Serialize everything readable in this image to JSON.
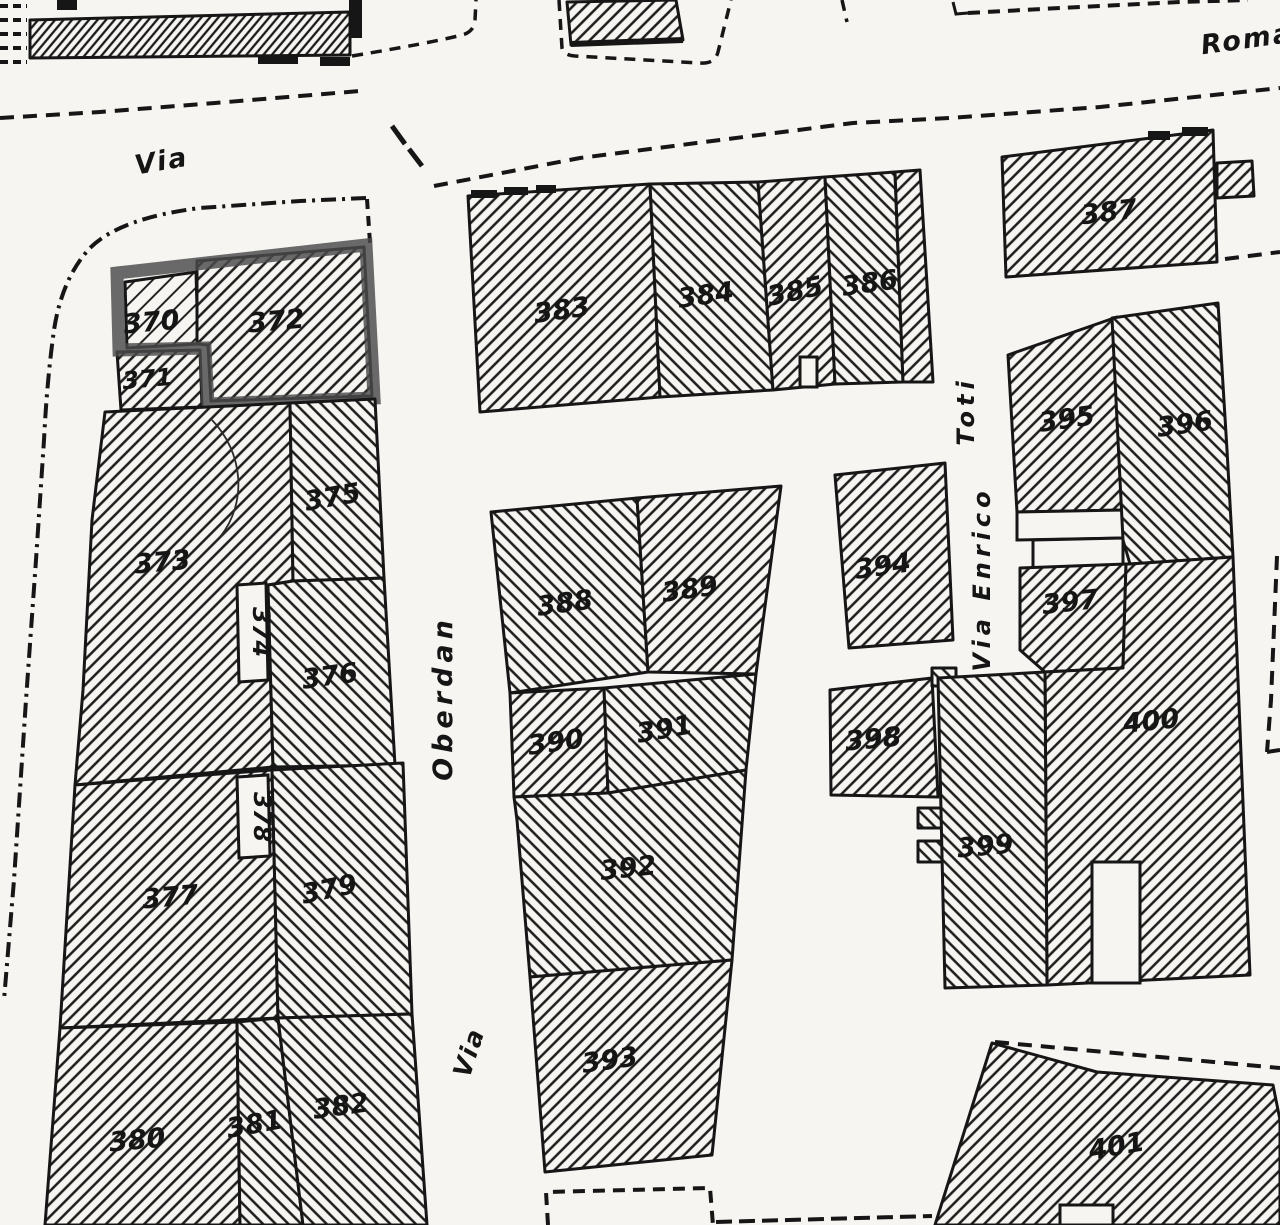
{
  "map_type": "cadastral-plan-scan",
  "colors": {
    "paper": "#f7f5f1",
    "ink": "#161616",
    "highlight_outline": "#4a4a4a"
  },
  "streets": {
    "via_top": "Via",
    "roma": "Roma",
    "oberdan": "Oberdan",
    "via_lower": "Via",
    "via_enrico": "Via Enrico",
    "toti": "Toti"
  },
  "parcels": [
    {
      "label": "370"
    },
    {
      "label": "371"
    },
    {
      "label": "372"
    },
    {
      "label": "373"
    },
    {
      "label": "374"
    },
    {
      "label": "375"
    },
    {
      "label": "376"
    },
    {
      "label": "377"
    },
    {
      "label": "378"
    },
    {
      "label": "379"
    },
    {
      "label": "380"
    },
    {
      "label": "381"
    },
    {
      "label": "382"
    },
    {
      "label": "383"
    },
    {
      "label": "384"
    },
    {
      "label": "385"
    },
    {
      "label": "386"
    },
    {
      "label": "387"
    },
    {
      "label": "388"
    },
    {
      "label": "389"
    },
    {
      "label": "390"
    },
    {
      "label": "391"
    },
    {
      "label": "392"
    },
    {
      "label": "393"
    },
    {
      "label": "394"
    },
    {
      "label": "395"
    },
    {
      "label": "396"
    },
    {
      "label": "397"
    },
    {
      "label": "398"
    },
    {
      "label": "399"
    },
    {
      "label": "400"
    },
    {
      "label": "401"
    }
  ]
}
